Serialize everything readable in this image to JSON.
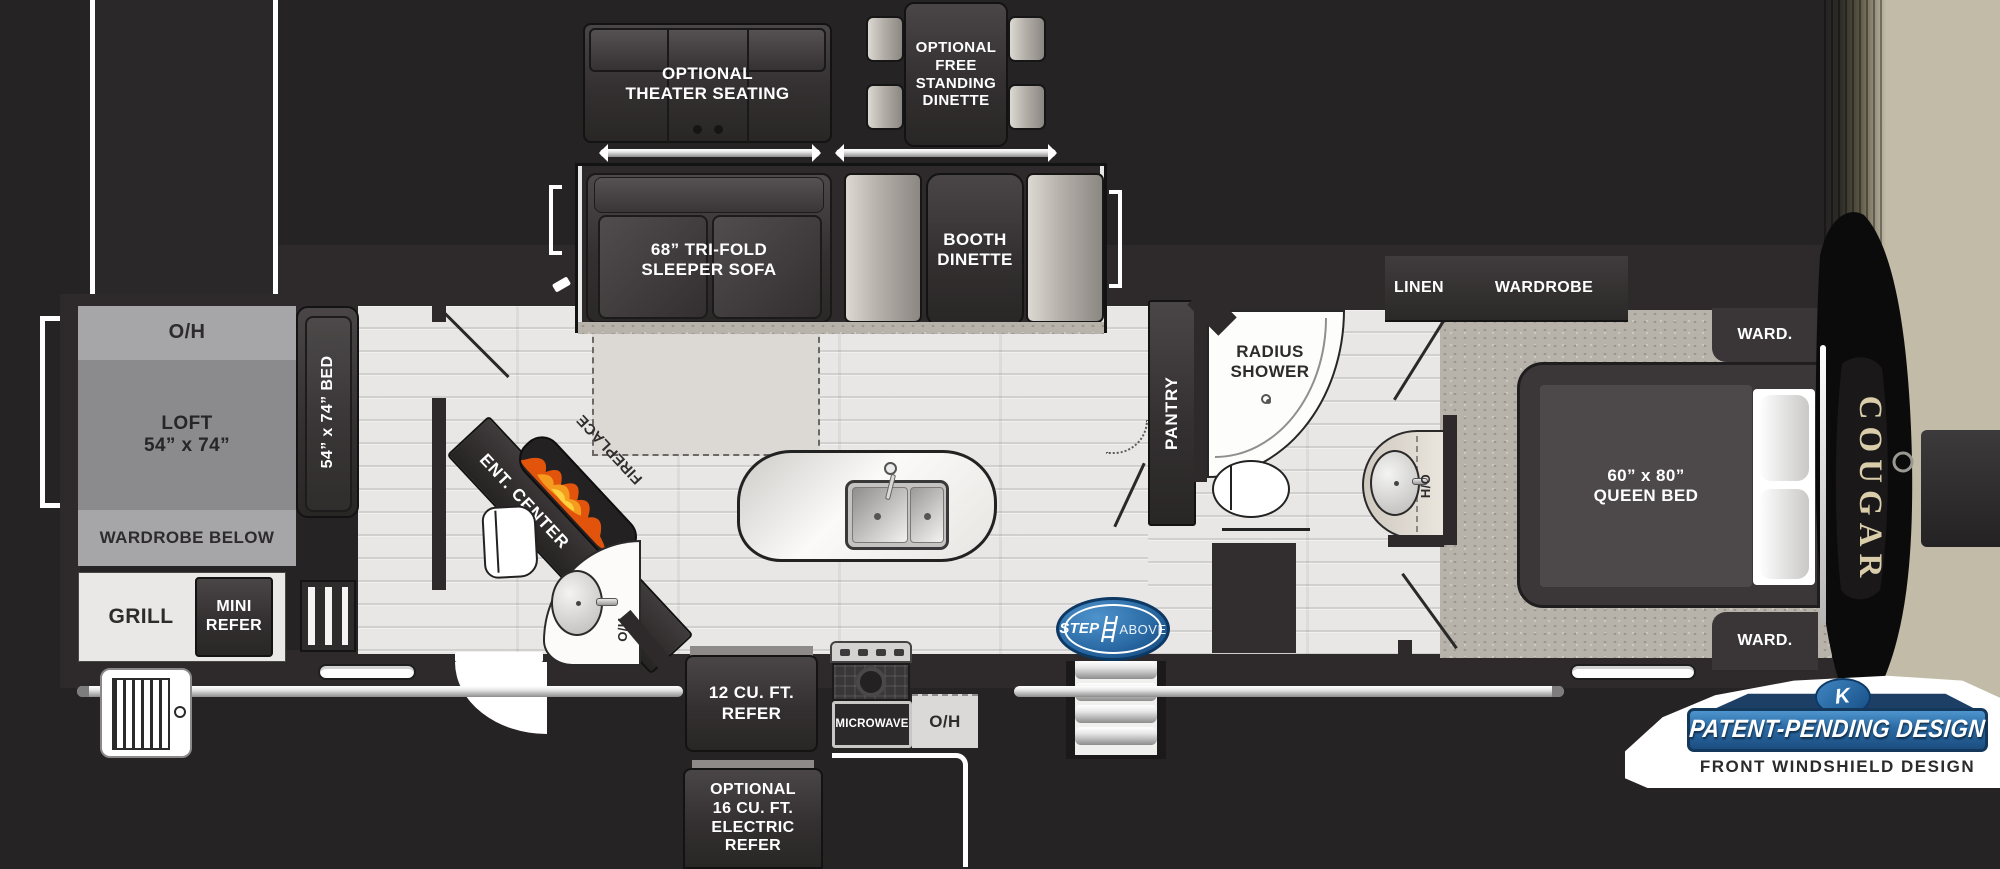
{
  "colors": {
    "background": "#262324",
    "floor": "#e8e7e5",
    "carpet": "#b7b2aa",
    "badge_blue": "#2a6aa5",
    "stepabove_blue": "#2e77b6",
    "cougar_gold": "#d9cdaa",
    "flame_orange": "#e8630f"
  },
  "exterior_options": {
    "theater_seating": {
      "line1": "OPTIONAL",
      "line2": "THEATER SEATING"
    },
    "free_standing_dinette": {
      "line1": "OPTIONAL",
      "line2": "FREE",
      "line3": "STANDING",
      "line4": "DINETTE"
    },
    "electric_refer": {
      "line1": "OPTIONAL",
      "line2": "16 CU. FT.",
      "line3": "ELECTRIC",
      "line4": "REFER"
    }
  },
  "living_slide": {
    "sofa_line1": "68”  TRI-FOLD",
    "sofa_line2": "SLEEPER SOFA",
    "booth_line1": "BOOTH",
    "booth_line2": "DINETTE"
  },
  "rear": {
    "overhead": "O/H",
    "loft_line1": "LOFT",
    "loft_line2": "54” x 74”",
    "bed": "54” x 74” BED",
    "wardrobe_below": "WARDROBE BELOW",
    "grill": "GRILL",
    "mini_refer_line1": "MINI",
    "mini_refer_line2": "REFER"
  },
  "living": {
    "ent_center": "ENT. CENTER",
    "fireplace": "FIREPLACE",
    "half_bath_hamper": "H/O"
  },
  "galley": {
    "refer_line1": "12 CU. FT.",
    "refer_line2": "REFER",
    "microwave": "MICROWAVE",
    "overhead": "O/H"
  },
  "bath": {
    "pantry": "PANTRY",
    "shower_line1": "RADIUS",
    "shower_line2": "SHOWER",
    "hamper": "H/O"
  },
  "bedroom": {
    "linen": "LINEN",
    "wardrobe": "WARDROBE",
    "ward_top": "WARD.",
    "ward_bottom": "WARD.",
    "bed_line1": "60” x 80”",
    "bed_line2": "QUEEN BED"
  },
  "branding": {
    "cougar": "COUGAR",
    "step": "STEP",
    "above": "ABOVE",
    "keystone_initial": "K",
    "patent": "PATENT-PENDING DESIGN",
    "windshield": "FRONT WINDSHIELD DESIGN"
  }
}
